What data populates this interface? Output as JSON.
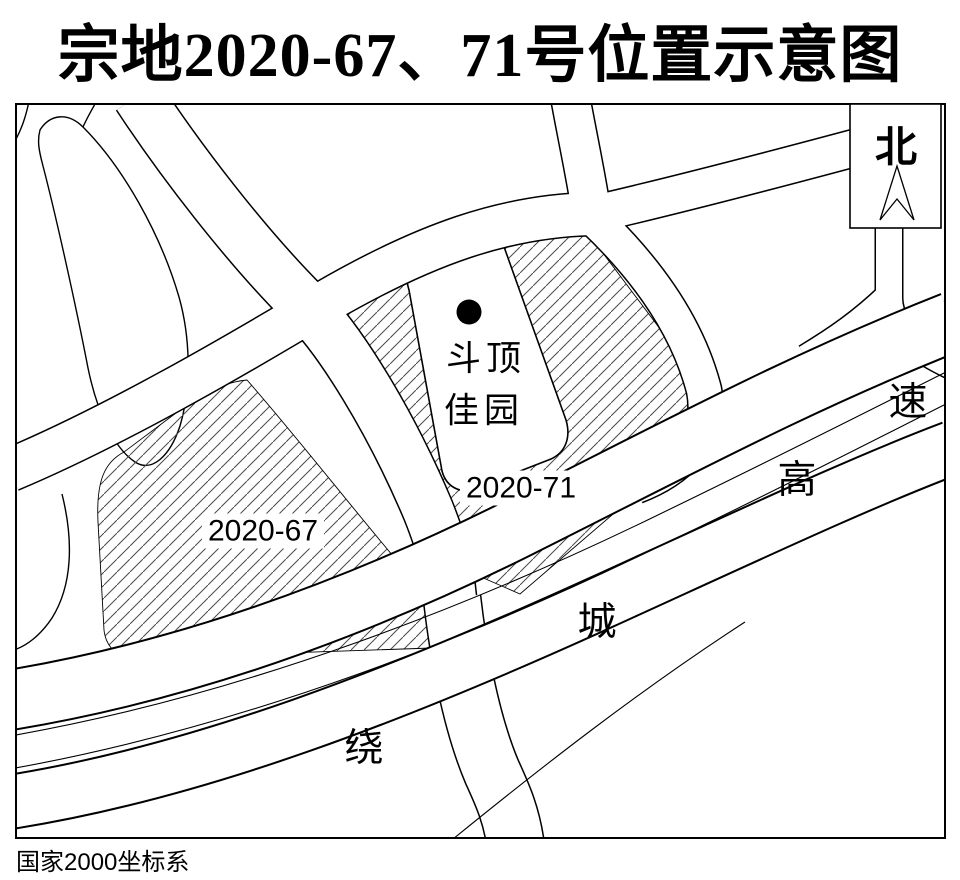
{
  "title": "宗地2020-67、71号位置示意图",
  "north": {
    "label": "北"
  },
  "parcels": {
    "p67": {
      "label": "2020-67"
    },
    "p71": {
      "label": "2020-71"
    }
  },
  "building": {
    "line1": "斗顶",
    "line2": "佳园"
  },
  "highway": {
    "name": "绕城高速",
    "char_rao": "绕",
    "char_cheng": "城",
    "char_gao": "高",
    "char_su": "速"
  },
  "footer": {
    "coordinate_system": "国家2000坐标系"
  },
  "colors": {
    "line": "#000000",
    "hatch": "#4a4a4a",
    "background": "#ffffff"
  }
}
